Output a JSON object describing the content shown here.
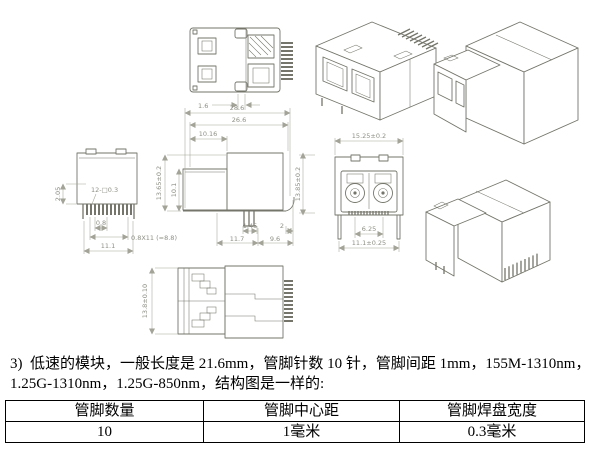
{
  "paragraph": {
    "line1": "3)  低速的模块，一般长度是 21.6mm，管脚针数 10 针，管脚间距 1mm，155M-1310nm，",
    "line2": "1.25G-1310nm，1.25G-850nm，结构图是一样的:"
  },
  "table": {
    "headers": [
      "管脚数量",
      "管脚中心距",
      "管脚焊盘宽度"
    ],
    "rows": [
      [
        "10",
        "1毫米",
        "0.3毫米"
      ]
    ]
  },
  "drawing": {
    "dims": {
      "top_tab_width": "1.6",
      "overall_length": "28.6",
      "body_length": "26.6",
      "front_offset": "10.16",
      "body_height": "13.65±0.2",
      "inner_height": "10.1",
      "overall_height": "13.85±0.2",
      "pin_width": "1.45",
      "tail_length": "2",
      "front_length": "11.7",
      "rear_length": "9.6",
      "pin_exposed": "2.05",
      "pin_spec": "12-□0.3",
      "pin_pitch": "0.8",
      "pin_span": "0.8X11 (=8.8)",
      "pin_row_width": "11.1",
      "front_width": "15.25±0.2",
      "port_pitch": "6.25",
      "leg_span": "11.1±0.25",
      "bottom_height": "13.8±0.10"
    }
  },
  "colors": {
    "line": "#75756b",
    "dim": "#a3a398",
    "table_border": "#000000"
  }
}
